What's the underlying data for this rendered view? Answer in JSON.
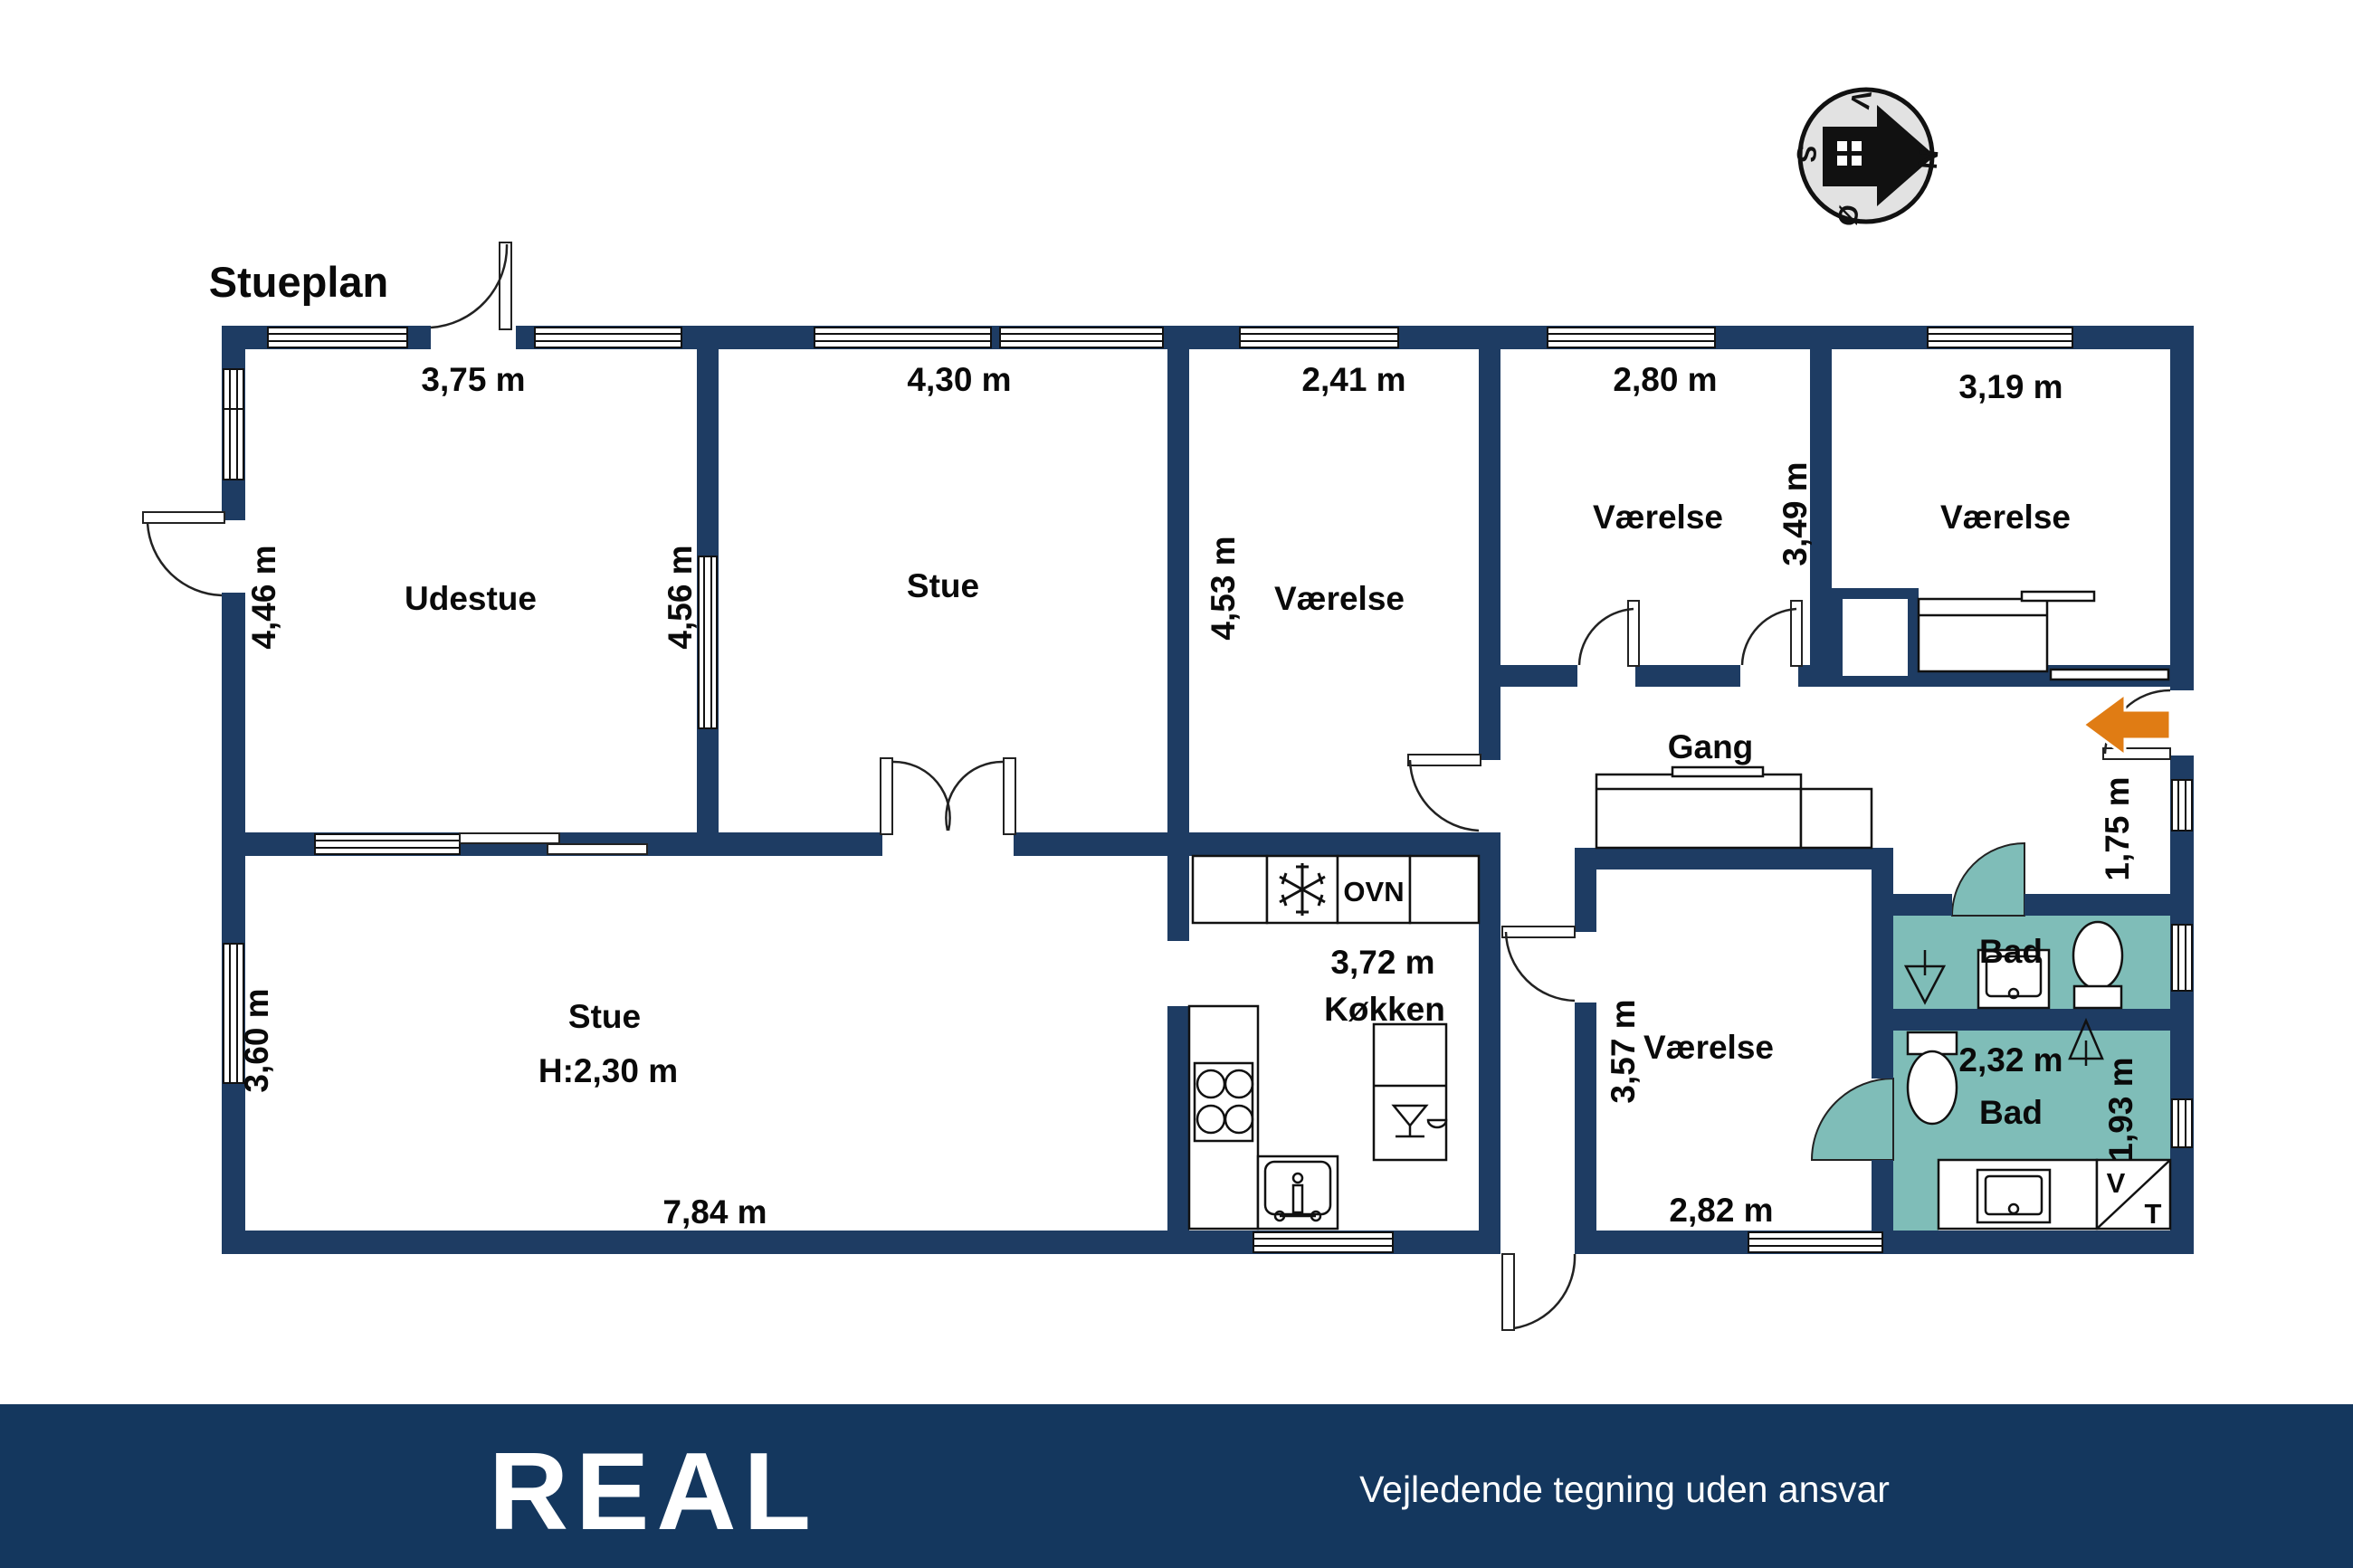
{
  "title": "Stueplan",
  "compass": {
    "north": "N",
    "south": "S",
    "west": "V",
    "east": "Ø"
  },
  "rooms": {
    "udestue": {
      "name": "Udestue",
      "width": "3,75 m",
      "depth": "4,46 m"
    },
    "stue_top": {
      "name": "Stue",
      "width": "4,30 m",
      "depth": "4,56 m"
    },
    "vaerelse1": {
      "name": "Værelse",
      "width": "2,41 m",
      "depth": "4,53 m"
    },
    "vaerelse2": {
      "name": "Værelse",
      "width": "2,80 m",
      "depth": "3,49 m"
    },
    "vaerelse3": {
      "name": "Værelse",
      "width": "3,19 m"
    },
    "gang": {
      "name": "Gang",
      "entry_width": "1,75 m"
    },
    "stue_lower": {
      "name": "Stue",
      "ceiling_height": "H:2,30 m",
      "width": "7,84 m",
      "depth": "3,60 m"
    },
    "koekken": {
      "name": "Køkken",
      "width": "3,72 m",
      "oven_label": "OVN"
    },
    "vaerelse4": {
      "name": "Værelse",
      "depth": "3,57 m",
      "width": "2,82 m"
    },
    "bad_upper": {
      "name": "Bad"
    },
    "bad_lower": {
      "name": "Bad",
      "width": "2,32 m",
      "depth": "1,93 m"
    },
    "utility": {
      "washer_label": "V",
      "dryer_label": "T"
    }
  },
  "icons": {
    "compass-rose-icon": "house arrow pointing to N (east-rotated dial)",
    "entrance-arrow-icon": "orange arrow pointing into entrance",
    "freezer-snowflake-icon": "snowflake",
    "stove-icon": "4 burner circles",
    "kitchen-sink-icon": "sink with faucet",
    "dishwasher-icon": "glass symbol",
    "toilet-icon": "toilet oval with tank",
    "washbasin-icon": "basin square with drain dot",
    "floor-drain-icon": "shower drain triangle",
    "wardrobe-icon": "built-in closet box"
  },
  "colors": {
    "wall": "#1e3c63",
    "bath": "#7fbdb8",
    "entrance_arrow": "#e07c14",
    "footer_background": "#14375e",
    "compass_fill": "#e2e2e2"
  },
  "footer": {
    "logo": "REAL",
    "tagline": "Vejledende tegning uden ansvar"
  }
}
